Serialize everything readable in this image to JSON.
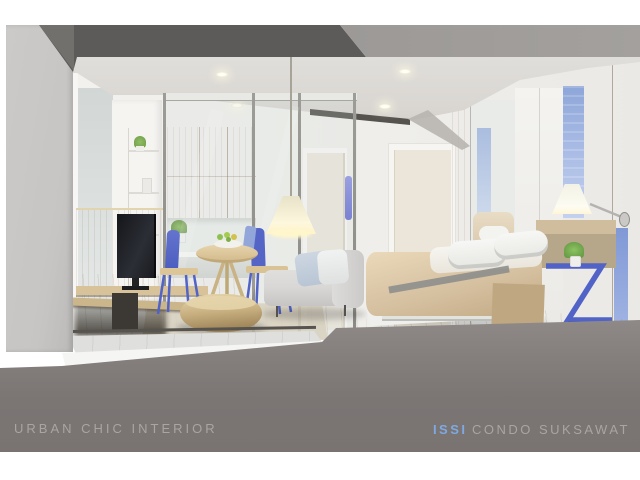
{
  "footer": {
    "project_label": "URBAN CHIC INTERIOR",
    "brand": "ISSI",
    "brand_suffix": "CONDO  SUKSAWAT"
  },
  "colors": {
    "accent_blue": "#7fa9e0",
    "furniture_blue": "#5163c6",
    "window_blue": "#9db1e0",
    "footer_gray": "#7b7574",
    "footer_text_gray": "#a9a5a3",
    "band_dark": "#5c5b59",
    "band_mid": "#9c9997",
    "ceiling_gray": "#d9d6d2",
    "wall_white": "#f1f0ed",
    "left_wall_gray": "#c7c5c3",
    "wood_cabinet": "#d6c094",
    "wood_floor": "#c9b289",
    "wood_wall_right": "#d3c1a2",
    "bed_beige": "#d5c0a0",
    "sofa_gray": "#d8d7d5",
    "pouf_tan": "#c7ae7f"
  }
}
